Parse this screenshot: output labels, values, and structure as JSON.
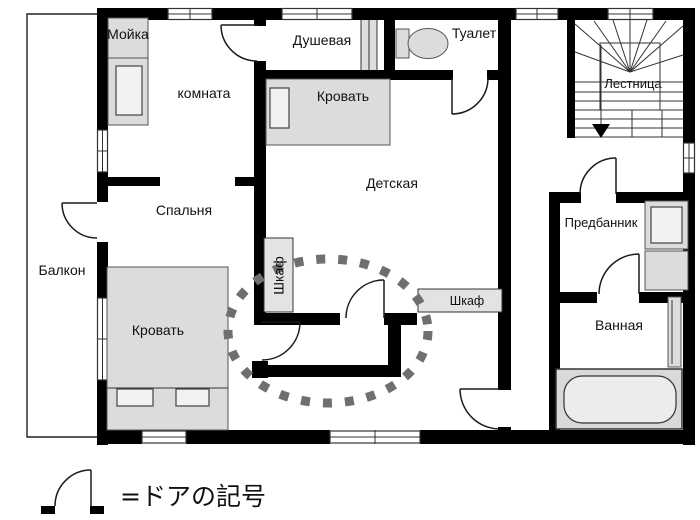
{
  "floorplan": {
    "rooms": {
      "mojka": "Мойка",
      "komnata": "комната",
      "dushevaya": "Душевая",
      "tualet": "Туалет",
      "lestnitsa": "Лестница",
      "krovat_detskaya": "Кровать",
      "detskaya": "Детская",
      "spalnya": "Спальня",
      "predbannik": "Предбанник",
      "balkon": "Балкон",
      "krovat_spalnya": "Кровать",
      "shkaf_vertical": "Шкаф",
      "shkaf_horizontal": "Шкаф",
      "vannaya": "Ванная"
    },
    "legend": {
      "symbol": "door-arc-symbol",
      "label": "=ドアの記号"
    },
    "highlight": {
      "shape": "dashed-ellipse",
      "cx": 328,
      "cy": 331,
      "rx": 100,
      "ry": 72,
      "color": "#6f6f6f"
    },
    "colors": {
      "wall": "#000000",
      "background": "#ffffff",
      "fixture_fill": "#dcdcdc",
      "fixture_fill_light": "#f2f2f2",
      "highlight_dash": "#6f6f6f"
    }
  }
}
